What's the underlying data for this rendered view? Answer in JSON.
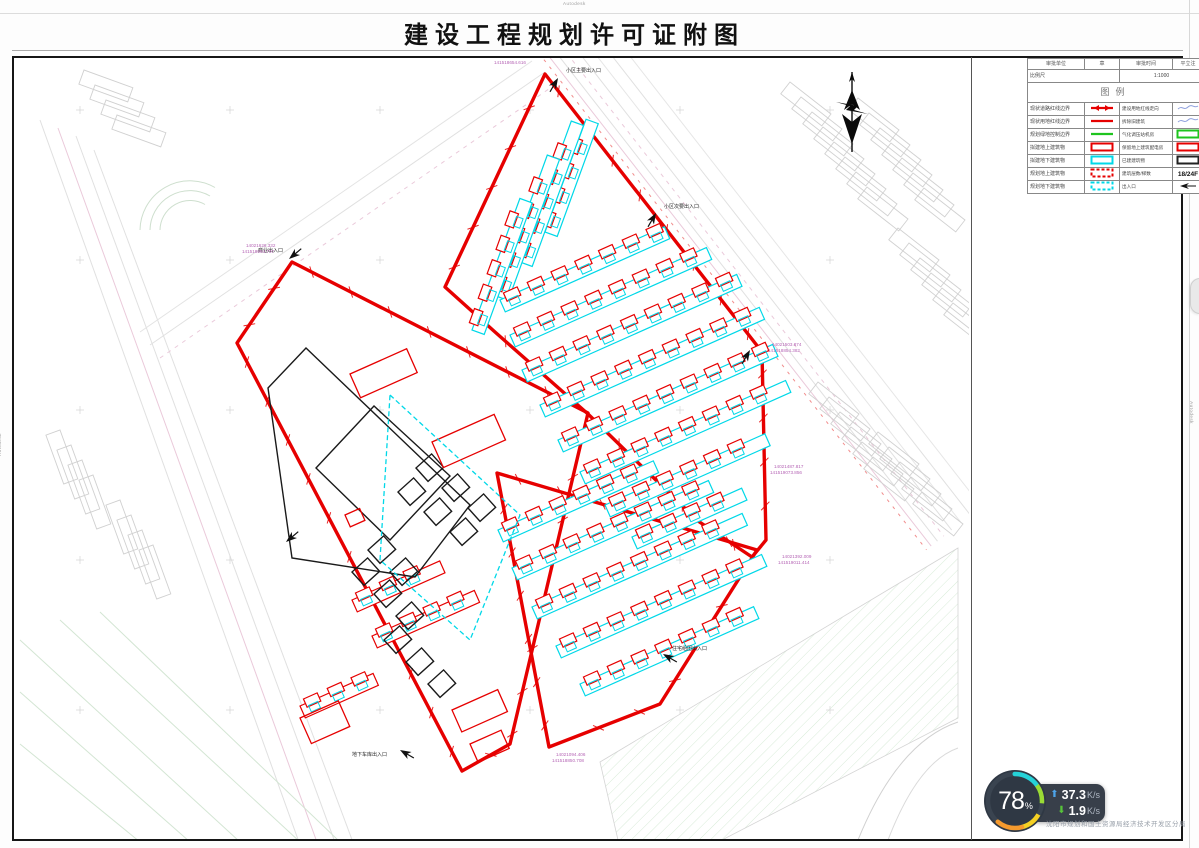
{
  "title": {
    "text": "建设工程规划许可证附图"
  },
  "watermarks": {
    "top": "Autodesk",
    "left": "Autodesk",
    "right": "Autodesk"
  },
  "legend_table": {
    "header": [
      "审批单位",
      "章",
      "审批时间",
      "平立注"
    ],
    "scale_label": "比例尺",
    "scale_value": "1:1000",
    "legend_title": "图例",
    "rows": [
      {
        "c1": "现状道路红线边界",
        "s1": "red-double-arrow",
        "c2": "建设用地红线走向",
        "s2": "sig"
      },
      {
        "c1": "现状用地红线边界",
        "s1": "red-line",
        "c2": "拆除旧建筑",
        "s2": "sig"
      },
      {
        "c1": "规划绿地控制边界",
        "s1": "green-line",
        "c2": "气化调压站机房",
        "s2": "green-rect"
      },
      {
        "c1": "拟建地上建筑物",
        "s1": "red-rect",
        "c2": "保留地上建筑配电房",
        "s2": "red-rect"
      },
      {
        "c1": "拟建地下建筑物",
        "s1": "cyan-rect",
        "c2": "已建建筑物",
        "s2": "black-rect"
      },
      {
        "c1": "规划地上建筑物",
        "s1": "red-dash-rect",
        "c2": "建筑层数/梯数",
        "s2": "floors",
        "s2_text": "18/24F"
      },
      {
        "c1": "规划地下建筑物",
        "s1": "cyan-dash-rect",
        "c2": "出入口",
        "s2": "entr-arrow"
      }
    ]
  },
  "drawing": {
    "entrance_labels": [
      {
        "t": "小区主要出入口",
        "x": 566,
        "y": 72
      },
      {
        "t": "小区次要出入口",
        "x": 664,
        "y": 208
      },
      {
        "t": "住宅组团出入口",
        "x": 672,
        "y": 650
      },
      {
        "t": "商业出入口",
        "x": 258,
        "y": 252
      },
      {
        "t": "地下车库出入口",
        "x": 352,
        "y": 756
      }
    ],
    "coord_labels": [
      {
        "t": "14021626.332",
        "x": 246,
        "y": 247
      },
      {
        "t": "141518694.737",
        "x": 242,
        "y": 253
      },
      {
        "t": "14021808.717",
        "x": 498,
        "y": 58
      },
      {
        "t": "141518654.616",
        "x": 494,
        "y": 64
      },
      {
        "t": "14021503.874",
        "x": 772,
        "y": 346
      },
      {
        "t": "141518854.382",
        "x": 768,
        "y": 352
      },
      {
        "t": "14021487.817",
        "x": 774,
        "y": 468
      },
      {
        "t": "141519073.856",
        "x": 770,
        "y": 474
      },
      {
        "t": "14021392.009",
        "x": 782,
        "y": 558
      },
      {
        "t": "141519011.414",
        "x": 778,
        "y": 564
      },
      {
        "t": "14021094.406",
        "x": 556,
        "y": 756
      },
      {
        "t": "141518850.708",
        "x": 552,
        "y": 762
      }
    ]
  },
  "colors": {
    "boundary_red": "#e60000",
    "building_cyan": "#00d8e8",
    "green_line": "#1ec41e",
    "context_gray": "#cccccc",
    "coord_magenta": "#b565b5"
  },
  "net_widget": {
    "percent": "78",
    "percent_symbol": "%",
    "up_value": "37.3",
    "up_unit": "K/s",
    "down_value": "1.9",
    "down_unit": "K/s"
  },
  "bureau_text": "沈阳市规划和国土资源局经济技术开发区分局"
}
